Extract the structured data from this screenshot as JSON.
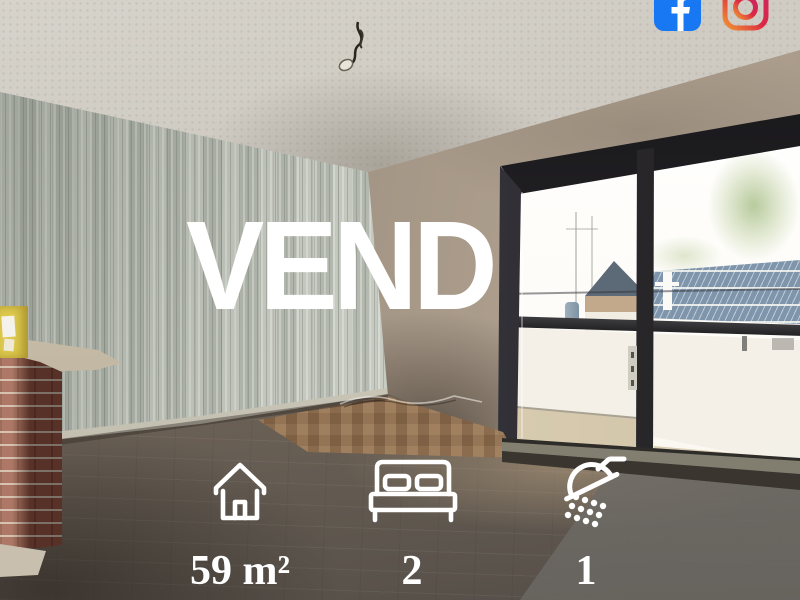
{
  "overlay": {
    "status_text": "VEND",
    "text_color": "#FFFFFF"
  },
  "listing": {
    "features": [
      {
        "icon": "house-outline-icon",
        "label": "59 m²"
      },
      {
        "icon": "double-bed-icon",
        "label": "2"
      },
      {
        "icon": "shower-head-icon",
        "label": "1"
      }
    ]
  },
  "social": {
    "facebook": {
      "icon": "facebook-f-icon",
      "color": "#1877F2"
    },
    "instagram": {
      "icon": "instagram-outline-icon",
      "gradient_start": "#F09433",
      "gradient_mid": "#DC2743",
      "gradient_end": "#CC2366"
    }
  },
  "scene": {
    "palette": {
      "wallpaper": "#C3C7BD",
      "right_wall": "#A39585",
      "floor": "#7A6D61",
      "window_frame": "#1F1E20",
      "roof_blue": "#7E95AB",
      "brick": "#8D4F3F"
    }
  }
}
